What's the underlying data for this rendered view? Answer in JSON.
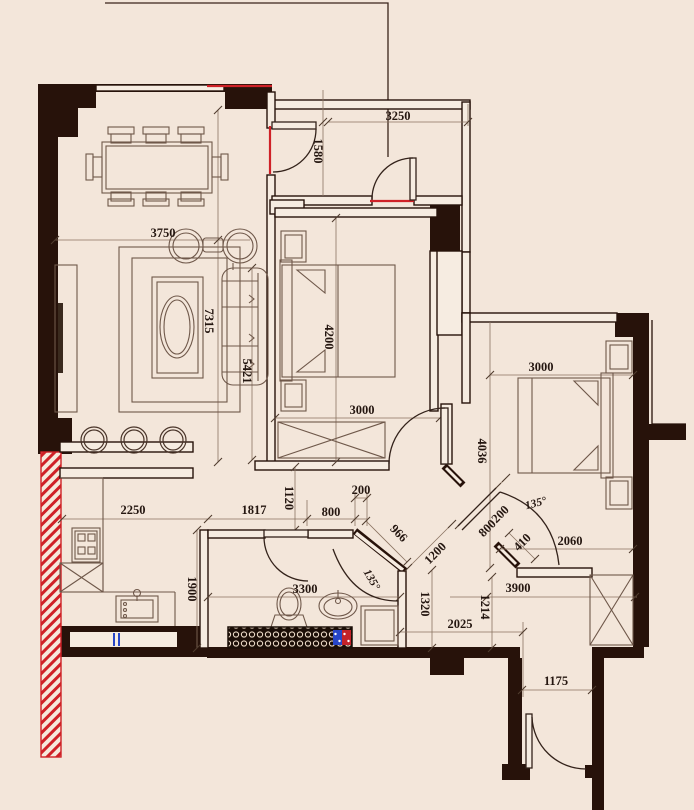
{
  "drawing": {
    "kind": "apartment floor plan",
    "colors": {
      "background": "#f3e6da",
      "walls": "#27120a",
      "red_accent": "#cf2127",
      "blue_accent": "#2746c8",
      "pattern_ring": "#ead9c6"
    },
    "dims": {
      "top_width": "3250",
      "entry_opening": "1580",
      "living_width": "3750",
      "living_length": "7315",
      "sofa_length": "5421",
      "bedroom1_length": "4200",
      "bedroom1_width": "3000",
      "bedroom2_width": "3000",
      "bedroom2_length": "4036",
      "bedroom2_side": "2060",
      "door2_seg_a": "200",
      "door2_seg_b": "800",
      "door2_seg_c": "410",
      "door2_angle": "135°",
      "corridor_a": "966",
      "corridor_b": "1200",
      "shower_angle": "135°",
      "hall_a": "1120",
      "hall_b": "200",
      "hall_c": "800",
      "hall_d": "1817",
      "kitchen_width": "2250",
      "kitchen_depth": "1900",
      "bath_width": "3300",
      "foyer_a": "1320",
      "foyer_b": "1214",
      "foyer_c": "2025",
      "foyer_d": "3900",
      "entry_door_width": "1175"
    }
  }
}
